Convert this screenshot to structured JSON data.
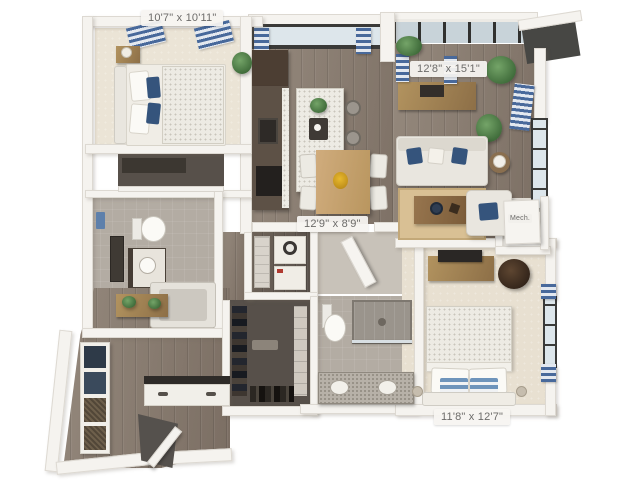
{
  "floorplan": {
    "dimension_labels": {
      "bedroom_top_left": "10'7\" x 10'11\"",
      "living_room": "12'8\" x 15'1\"",
      "dining_kitchen": "12'9\" x 8'9\"",
      "bedroom_bottom_right": "11'8\" x 12'7\"",
      "mech_closet": "Mech."
    },
    "colors": {
      "background": "#ffffff",
      "wall": "#f5f3ef",
      "wood_floor": "#877b70",
      "carpet": "#ebe4d6",
      "tile": "#b3aca3",
      "curtain_blue": "#48699b",
      "navy_pillow": "#35547c",
      "rug_tan": "#d9c094",
      "window_frame": "#3a3a38",
      "counter_dark": "#564a40",
      "wood_furniture": "#a8895e",
      "plant_green": "#55804c",
      "label_text": "#6c6b69",
      "label_background": "#f6f4f1"
    }
  }
}
